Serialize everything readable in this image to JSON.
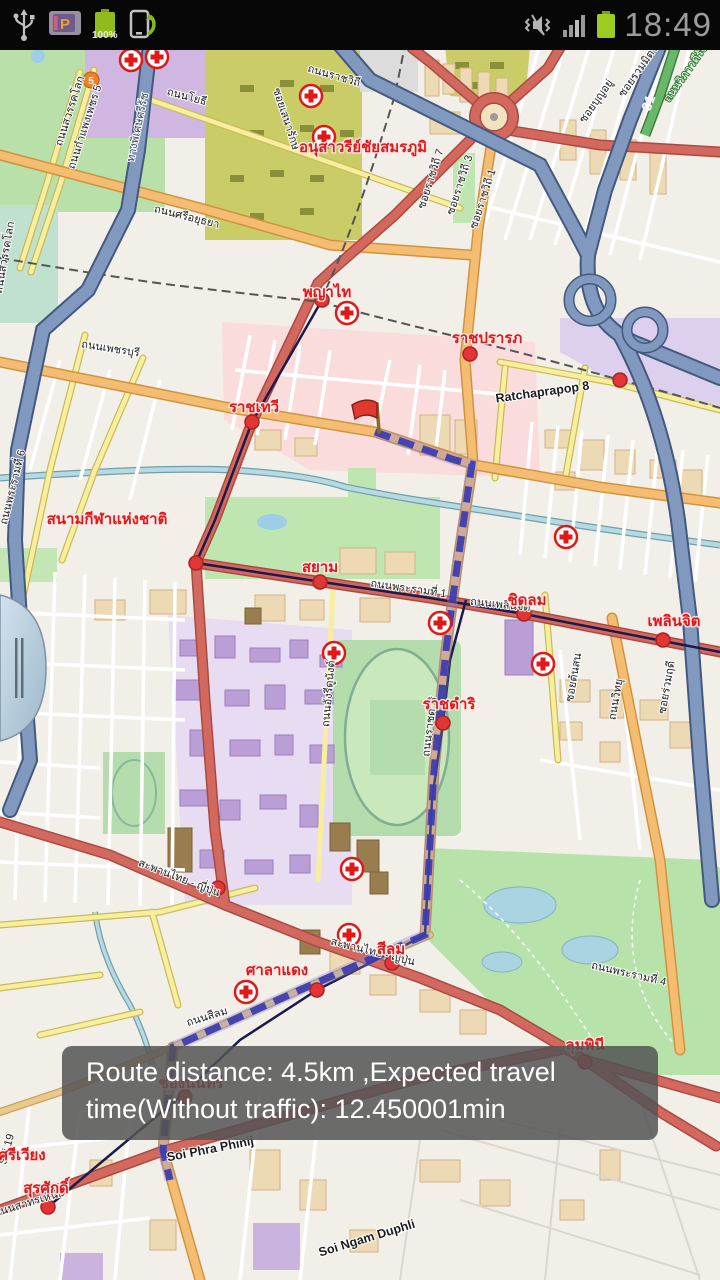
{
  "status_bar": {
    "time": "18:49",
    "battery_level_label": "100%",
    "left_icons": [
      "usb-icon",
      "parking-app-icon",
      "battery-full-icon",
      "screen-rotate-icon"
    ],
    "right_icons": [
      "mute-vibrate-icon",
      "signal-strength-icon",
      "battery-icon"
    ]
  },
  "toast": {
    "message": "Route distance: 4.5km ,Expected travel time(Without traffic): 12.450001min"
  },
  "map": {
    "route_style": {
      "color": "#3b3bb0",
      "pattern": "dashed"
    },
    "colors": {
      "land": "#f2efe9",
      "park": "#b9e0a8",
      "water": "#b6d9e2",
      "pink_zone": "#fadcdc",
      "campus": "#e7dcf2",
      "military": "#c9cc67",
      "motorway": "#8199bf",
      "primary_road": "#d2685e",
      "trunk_road": "#f5bd72",
      "secondary_road": "#f7ef9f",
      "station_label": "#e01818",
      "toast_bg": "#545454"
    },
    "shields": {
      "highway5": "5",
      "highway31": "31"
    },
    "station_labels": [
      {
        "text": "อนุสาวรีย์ชัยสมรภูมิ"
      },
      {
        "text": "พญาไท"
      },
      {
        "text": "ราชปรารภ"
      },
      {
        "text": "ราชเทวี"
      },
      {
        "text": "สนามกีฬาแห่งชาติ"
      },
      {
        "text": "สยาม"
      },
      {
        "text": "ชิดลม"
      },
      {
        "text": "เพลินจิต"
      },
      {
        "text": "ราชดำริ"
      },
      {
        "text": "ศาลาแดง"
      },
      {
        "text": "สีลม"
      },
      {
        "text": "ลุมพินี"
      },
      {
        "text": "ช่องนนทรี"
      },
      {
        "text": "สุรศักดิ์"
      },
      {
        "text": "ศรีเวียง"
      }
    ],
    "road_labels": [
      {
        "text": "ถนนโยธี"
      },
      {
        "text": "ถนนราชวิถี"
      },
      {
        "text": "ซอยเสนารักษ์"
      },
      {
        "text": "ถนนสวรรคโลก"
      },
      {
        "text": "ถนนกำแพงเพชร 5"
      },
      {
        "text": "ทางพิเศษศรีรัช"
      },
      {
        "text": "ถนนศรีอยุธยา"
      },
      {
        "text": "ซอยราชวิถี 7"
      },
      {
        "text": "ซอยราชวิถี 3"
      },
      {
        "text": "ซอยราชวิถี 1"
      },
      {
        "text": "ซอยบุญอยู่"
      },
      {
        "text": "ซอยรวมมิตร"
      },
      {
        "text": "ถนนวิภาวดีรังสิต"
      },
      {
        "text": "Ratchaprapop 8"
      },
      {
        "text": "ถนนเพชรบุรี"
      },
      {
        "text": "ถนนพระรามที่ 6"
      },
      {
        "text": "ถนนพระรามที่ 1"
      },
      {
        "text": "ถนนเพลินจิต"
      },
      {
        "text": "ถนนราชดำริ"
      },
      {
        "text": "ถนนอังรีดูนังต์"
      },
      {
        "text": "ถนนวิทยุ"
      },
      {
        "text": "ซอยต้นสน"
      },
      {
        "text": "ซอยร่วมฤดี"
      },
      {
        "text": "ถนนสีลม"
      },
      {
        "text": "สะพานไทย - ญี่ปุ่น"
      },
      {
        "text": "สะพานไทย - ญี่ปุ่น"
      },
      {
        "text": "ถนนพระรามที่ 4"
      },
      {
        "text": "ถนนสาทรเหนือ"
      },
      {
        "text": "Soi Phra Phinij"
      },
      {
        "text": "Soi Ngam Duphli"
      },
      {
        "text": "Soi 19"
      },
      {
        "text": "ถนนสวรรคโลก"
      }
    ]
  }
}
